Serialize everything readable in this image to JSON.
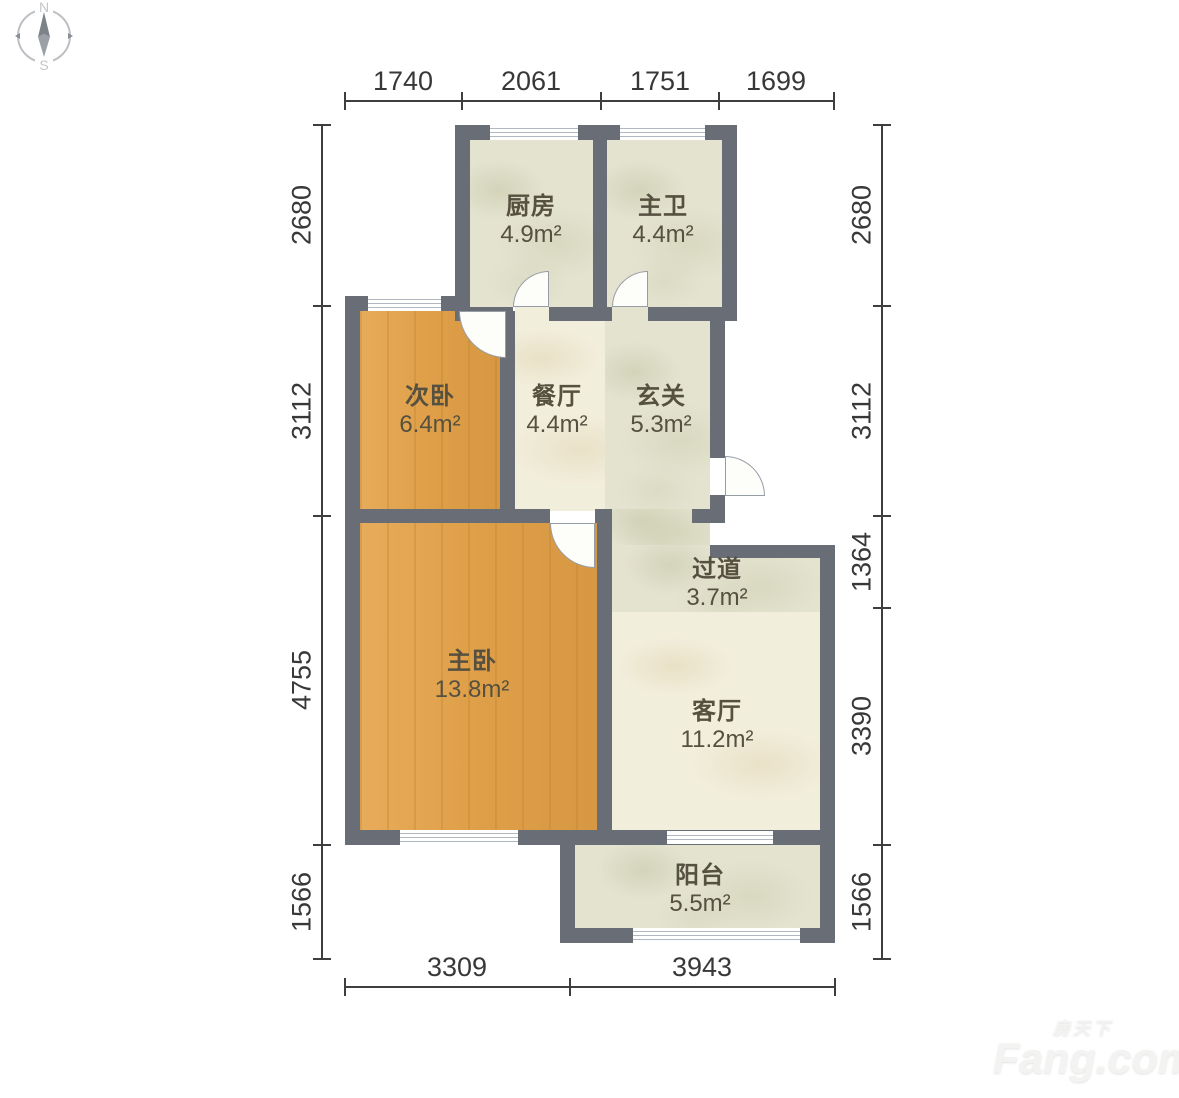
{
  "compass": {
    "north": "N",
    "south": "S"
  },
  "rooms": [
    {
      "name": "厨房",
      "area": "4.9m²"
    },
    {
      "name": "主卫",
      "area": "4.4m²"
    },
    {
      "name": "次卧",
      "area": "6.4m²"
    },
    {
      "name": "餐厅",
      "area": "4.4m²"
    },
    {
      "name": "玄关",
      "area": "5.3m²"
    },
    {
      "name": "主卧",
      "area": "13.8m²"
    },
    {
      "name": "过道",
      "area": "3.7m²"
    },
    {
      "name": "客厅",
      "area": "11.2m²"
    },
    {
      "name": "阳台",
      "area": "5.5m²"
    }
  ],
  "dimensions_mm": {
    "top": [
      "1740",
      "2061",
      "1751",
      "1699"
    ],
    "left": [
      "2680",
      "3112",
      "4755",
      "1566"
    ],
    "right": [
      "2680",
      "3112",
      "1364",
      "3390",
      "1566"
    ],
    "bottom": [
      "3309",
      "3943"
    ]
  },
  "watermark": {
    "site_cn": "房天下",
    "site_en": "Fang.com"
  },
  "colors": {
    "wall": "#686d76",
    "bedroom_floor": "#e0a04a",
    "living_floor": "#f2eedc",
    "service_floor": "#e4e3d0",
    "dimension_text": "#383838"
  }
}
